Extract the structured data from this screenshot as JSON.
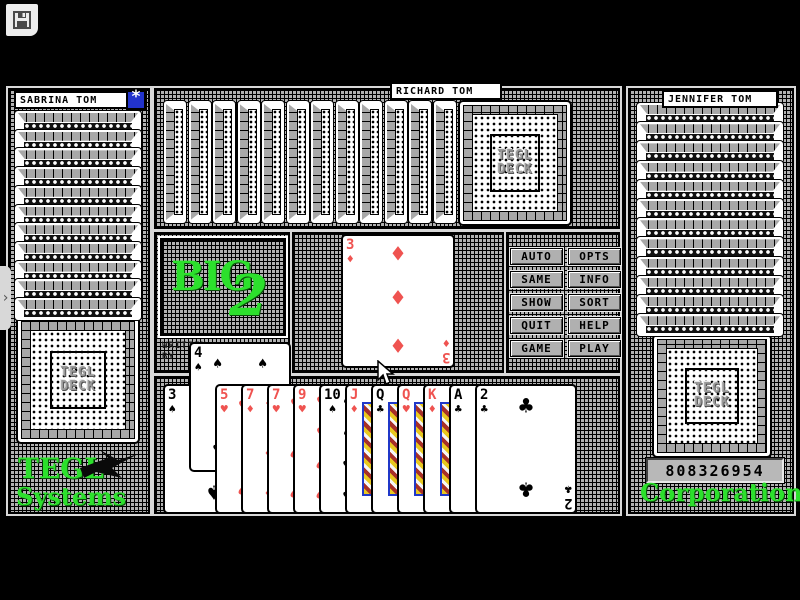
{
  "colors": {
    "card_red": "#ef5350",
    "accent_green": "#2ce02c",
    "star_blue": "#2233cc",
    "button_gray": "#b0b0b0"
  },
  "titlebar": {
    "save_icon": "floppy-disk"
  },
  "players": {
    "left": {
      "name": "SABRINA TOM",
      "face_down_strips": 11,
      "has_deck_card": true,
      "star_button": "*"
    },
    "top": {
      "name": "RICHARD TOM",
      "face_down_strips": 12,
      "has_deck_card": true
    },
    "right": {
      "name": "JENNIFER TOM",
      "face_down_strips": 12,
      "has_deck_card": true
    }
  },
  "deck": {
    "line1": "TEGL",
    "line2": "DECK"
  },
  "logo": {
    "big": "BIG",
    "two": "2",
    "credit_line1": "WRITTEN",
    "credit_line2": "BY"
  },
  "played_card": {
    "rank": "3",
    "suit": "diamond"
  },
  "buttons": [
    "AUTO",
    "OPTS",
    "SAME",
    "INFO",
    "SHOW",
    "SORT",
    "QUIT",
    "HELP",
    "GAME",
    "PLAY"
  ],
  "hand": {
    "cards": [
      {
        "rank": "3",
        "suit": "spade",
        "raised": false
      },
      {
        "rank": "4",
        "suit": "spade",
        "raised": true
      },
      {
        "rank": "5",
        "suit": "heart",
        "raised": false
      },
      {
        "rank": "7",
        "suit": "diamond",
        "raised": false
      },
      {
        "rank": "7",
        "suit": "heart",
        "raised": false
      },
      {
        "rank": "9",
        "suit": "heart",
        "raised": false
      },
      {
        "rank": "10",
        "suit": "spade",
        "raised": false
      },
      {
        "rank": "J",
        "suit": "diamond",
        "raised": false
      },
      {
        "rank": "Q",
        "suit": "club",
        "raised": false
      },
      {
        "rank": "Q",
        "suit": "heart",
        "raised": false
      },
      {
        "rank": "K",
        "suit": "diamond",
        "raised": false
      },
      {
        "rank": "A",
        "suit": "club",
        "raised": false
      },
      {
        "rank": "2",
        "suit": "club",
        "raised": false
      }
    ]
  },
  "branding": {
    "left_line1": "TEGL",
    "left_line2": "Systems",
    "right_text": "Corporation",
    "score": "808326954"
  },
  "misc": {
    "side_tab_chevron": "›",
    "mouse_cursor": "arrow"
  }
}
